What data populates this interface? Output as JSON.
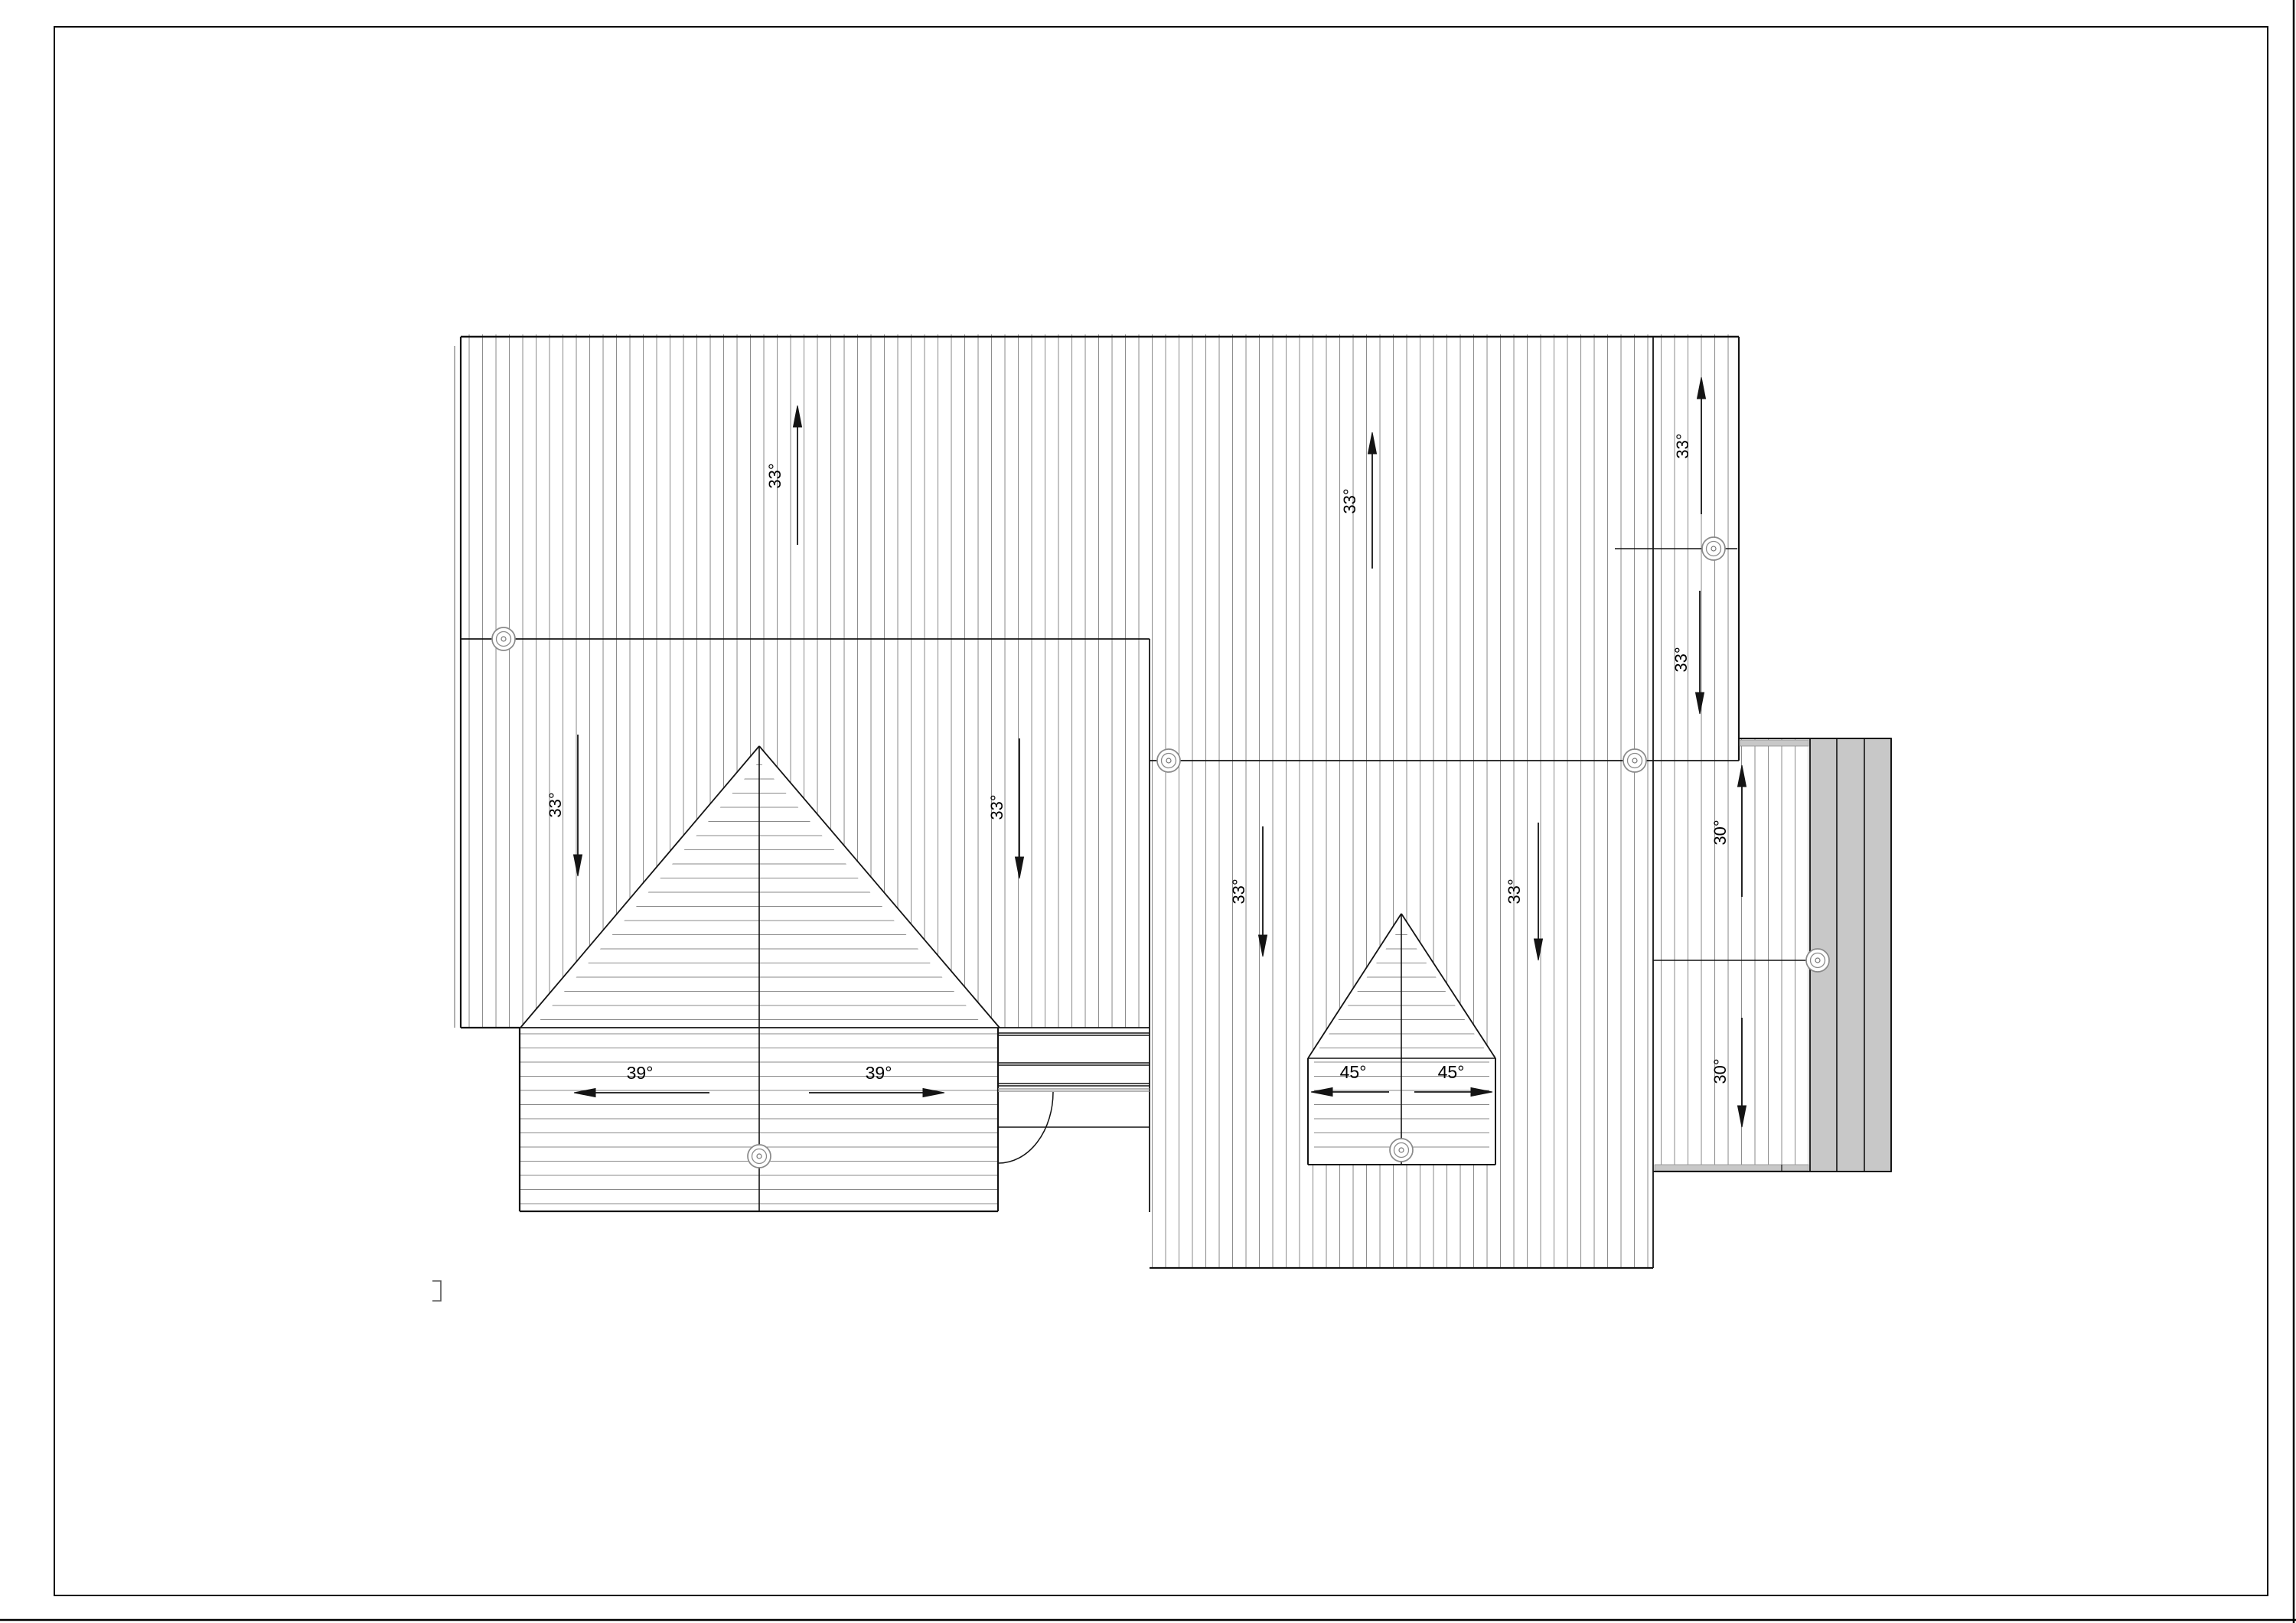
{
  "document": {
    "type": "roof-plan-cad-drawing",
    "background_color": "#ffffff"
  },
  "colors": {
    "outline": "#141414",
    "hatch_line": "#8e8e8e",
    "gray_panel_fill": "#c8c8c8",
    "vent_symbol": "#8a8a8a",
    "border": "#000000"
  },
  "annotations": [
    {
      "id": "slope-upper-left",
      "text": "33°",
      "orientation": "rotated",
      "direction": "up"
    },
    {
      "id": "slope-upper-middle",
      "text": "33°",
      "orientation": "rotated",
      "direction": "up"
    },
    {
      "id": "slope-strip-up",
      "text": "33°",
      "orientation": "rotated",
      "direction": "up"
    },
    {
      "id": "slope-strip-down",
      "text": "33°",
      "orientation": "rotated",
      "direction": "down"
    },
    {
      "id": "slope-left-block-west",
      "text": "33°",
      "orientation": "rotated",
      "direction": "down"
    },
    {
      "id": "slope-left-block-east",
      "text": "33°",
      "orientation": "rotated",
      "direction": "down"
    },
    {
      "id": "slope-right-block-west",
      "text": "33°",
      "orientation": "rotated",
      "direction": "down"
    },
    {
      "id": "slope-right-block-east",
      "text": "33°",
      "orientation": "rotated",
      "direction": "down"
    },
    {
      "id": "slope-wing-up",
      "text": "30°",
      "orientation": "rotated",
      "direction": "up"
    },
    {
      "id": "slope-wing-down",
      "text": "30°",
      "orientation": "rotated",
      "direction": "down"
    },
    {
      "id": "slope-garage-left",
      "text": "39°",
      "orientation": "horizontal",
      "direction": "left"
    },
    {
      "id": "slope-garage-right",
      "text": "39°",
      "orientation": "horizontal",
      "direction": "right"
    },
    {
      "id": "slope-small-gable-left",
      "text": "45°",
      "orientation": "horizontal",
      "direction": "left"
    },
    {
      "id": "slope-small-gable-right",
      "text": "45°",
      "orientation": "horizontal",
      "direction": "right"
    }
  ],
  "symbols": {
    "roof_vent_count": 7,
    "gray_panel_count": 3
  }
}
